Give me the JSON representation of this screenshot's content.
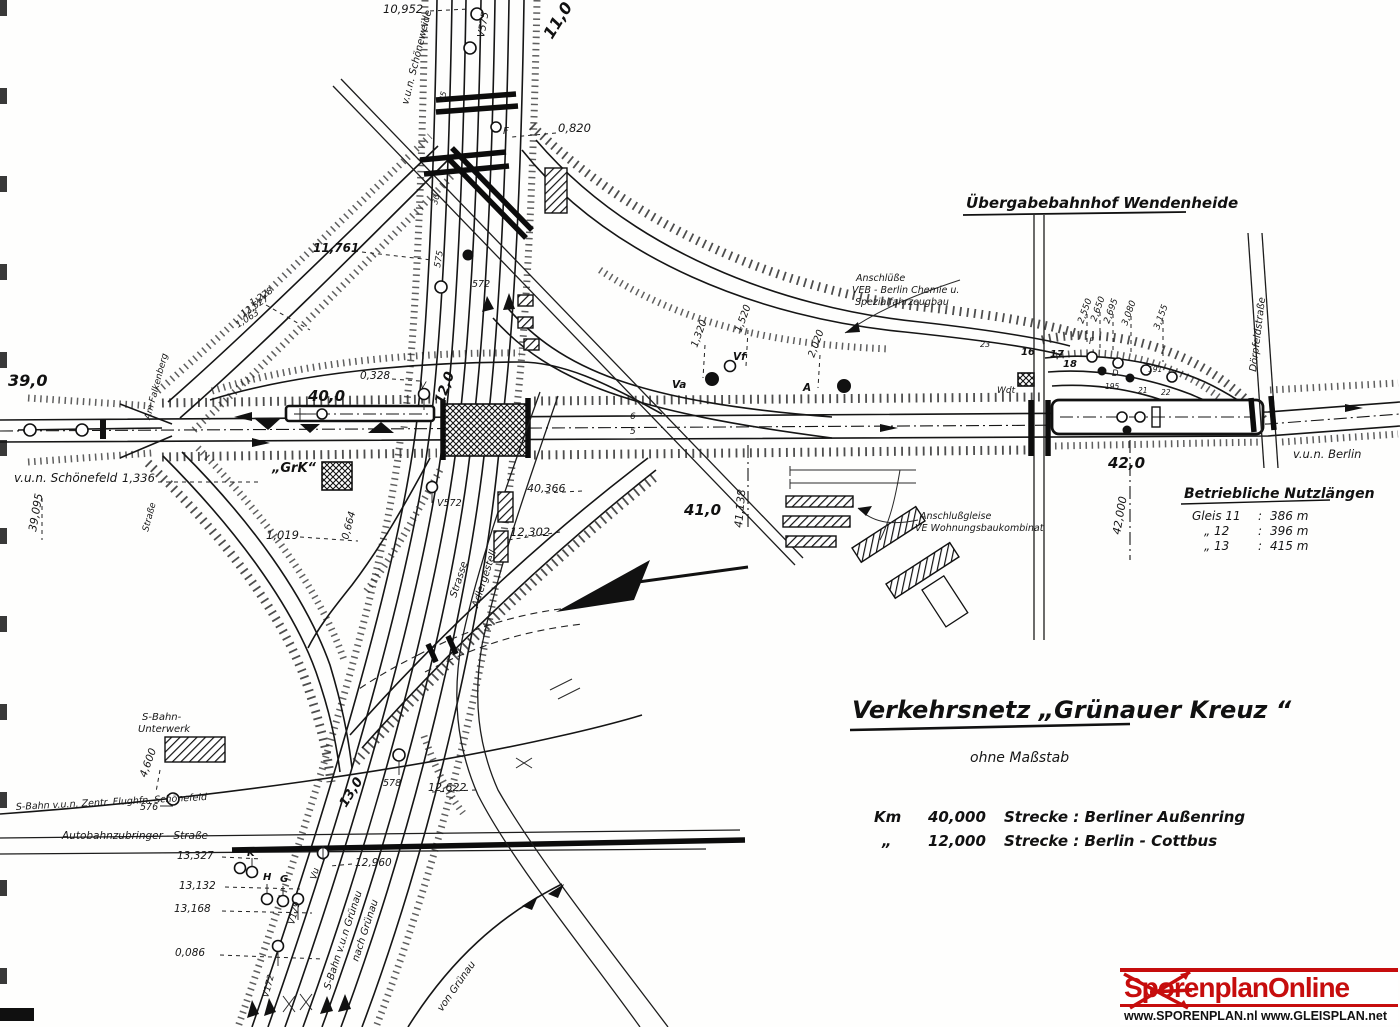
{
  "colors": {
    "ink": "#161616",
    "paper": "#fefefd",
    "logo_red": "#c60d0d"
  },
  "heading": {
    "wendenheide": "Übergabebahnhof  Wendenheide"
  },
  "title_block": {
    "title": "Verkehrsnetz   „Grünauer  Kreuz “",
    "subtitle": "ohne  Maßstab",
    "km_label": "Km",
    "row1_km": "40,000",
    "row1_strecke": "Strecke :  Berliner Außenring",
    "row2_ditto": "„",
    "row2_km": "12,000",
    "row2_strecke": "Strecke :  Berlin - Cottbus"
  },
  "nutzlaengen": {
    "heading": "Betriebliche Nutzlängen",
    "sep": ":",
    "rows": [
      {
        "gleis": "Gleis 11",
        "len": "386 m"
      },
      {
        "gleis": "„    12",
        "len": "396 m"
      },
      {
        "gleis": "„    13",
        "len": "415 m"
      }
    ]
  },
  "logo": {
    "name": "SporenplanOnline",
    "urls": "www.SPORENPLAN.nl  www.GLEISPLAN.net"
  },
  "labels": {
    "km_39_0": "39,0",
    "vun_schoenefeld": "v.u.n. Schönefeld",
    "n_1336": "1,336",
    "n_39095": "39,095",
    "am_falkenberg": "Am Falkenberg",
    "strasse_left": "Straße",
    "n_10952": "10,952",
    "v575": "V575",
    "km_11_0": "11,0",
    "vun_schoeneweide": "v.u.n. Schöneweide",
    "n_0820": "0,820",
    "f_sig": "F",
    "n_11761": "11,761",
    "s575": "575",
    "s572": "572",
    "n_25": "25",
    "n_30": "30",
    "n_1228": "1,228",
    "n_12527": "12,527",
    "n_1063": "1,063",
    "km_40_0": "40,0",
    "grk": "„GrK“",
    "n_0328": "0,328",
    "v_sig": "V",
    "km_12_0": "12,0",
    "n_1019": "1,019",
    "n_0664": "0,664",
    "v572": "V572",
    "n_40366": "40,366",
    "n_12302": "12,302",
    "strasse_diag": "Strasse",
    "adlergestell": "Adlergestell",
    "t5": "5",
    "t6": "6",
    "n_1320": "1,320",
    "n_1520": "1,520",
    "n_2020": "2,020",
    "vf_sig": "Vf",
    "va_sig": "Va",
    "a_sig": "A",
    "n_41138": "41,138",
    "km_41_0": "41,0",
    "anschluesse_1": "Anschlüße",
    "anschluesse_2": "VEB - Berlin Chemie u.",
    "anschluesse_3": "Spezialfahrzeugbau",
    "anschlussgleise_1": "Anschlußgleise",
    "anschlussgleise_2": "VE Wohnungsbaukombinat",
    "n_2550": "2,550",
    "n_2650": "2,650",
    "n_2695": "2,695",
    "n_3080": "3,080",
    "n_3155": "3,155",
    "t16": "16",
    "t17": "17",
    "t18": "18",
    "t23": "23",
    "d_sig": "D",
    "f2_sig": "F",
    "n_191": "191",
    "n_195": "195",
    "n_21": "21",
    "n_22": "22",
    "wdt": "Wdt",
    "km_42_0": "42,0",
    "n_42000": "42,000",
    "doerpfeldstrasse": "Dörpfeldstraße",
    "vun_berlin": "v.u.n. Berlin",
    "sbahn_unterwerk_1": "S-Bahn-",
    "sbahn_unterwerk_2": "Unterwerk",
    "n_4600": "4,600",
    "sbahn_schoenefeld": "S-Bahn v.u.n. Zentr. Flughfn. Schönefeld",
    "s576": "576",
    "autobahnzubringer": "Autobahnzubringer - Straße",
    "km_13_0": "13,0",
    "s578": "578",
    "n_12622": "12,622",
    "n_13327": "13,327",
    "n_13132": "13,132",
    "n_13168": "13,168",
    "n_0086": "0,086",
    "n_12960": "12,960",
    "k_sig": "K",
    "h_sig": "H",
    "g_sig": "G",
    "vu_sig": "Vu",
    "v172": "V172",
    "v179": "V179",
    "sbahn_gruenau": "S-Bahn  v.u.n  Grünau",
    "nach_gruenau": "nach Grünau",
    "von_gruenau": "von Grünau"
  }
}
